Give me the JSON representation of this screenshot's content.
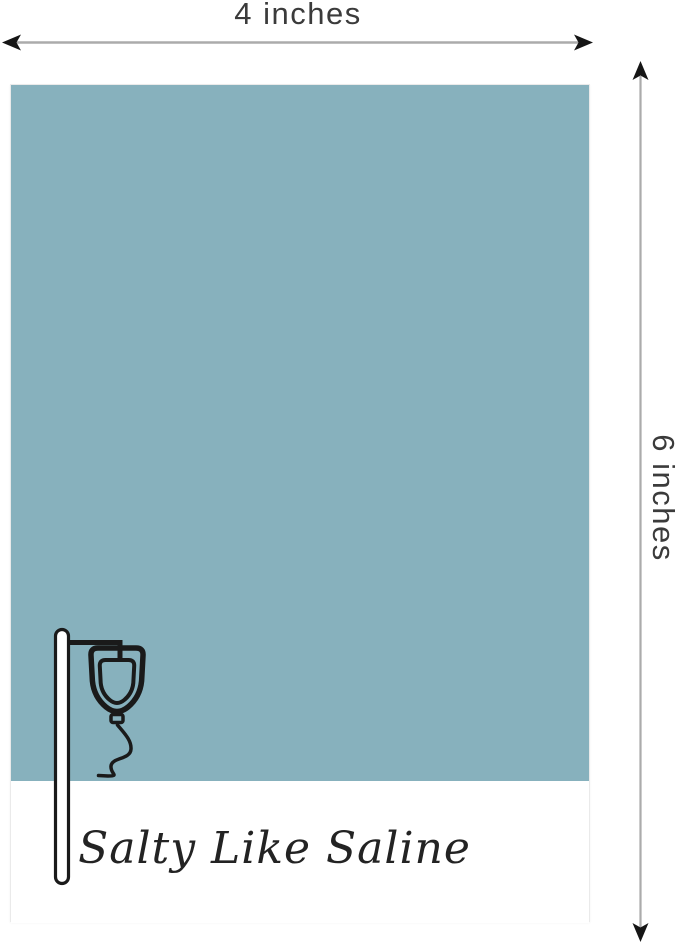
{
  "canvas": {
    "background": "#ffffff"
  },
  "dimensions": {
    "width_label": "4 inches",
    "height_label": "6 inches",
    "label_color": "#3b3b3b",
    "line_color": "#ababab",
    "arrowhead_color": "#151515"
  },
  "card": {
    "caption": "Salty Like Saline",
    "caption_color": "#232323",
    "swatch_color": "#87b1bd",
    "footer_color": "#ffffff",
    "border_color": "#eaeaea",
    "illustration": "iv-drip-stand-line-art",
    "illustration_color": "#1a1a1a"
  }
}
